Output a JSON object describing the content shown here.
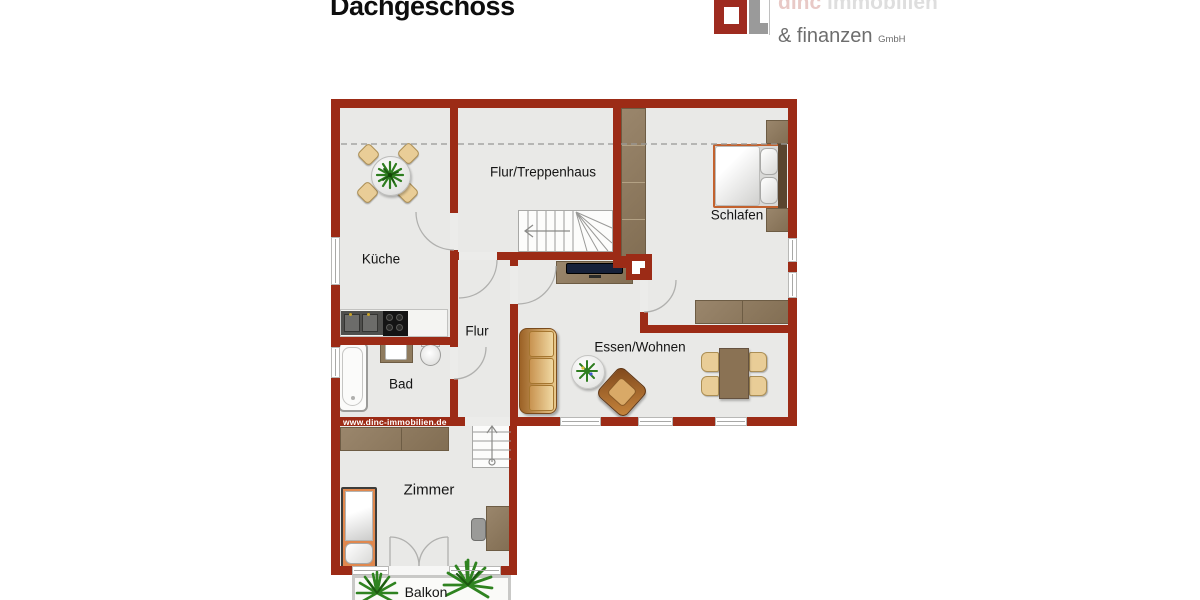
{
  "title": "Dachgeschoss",
  "watermark": "www.dinc-immobilien.de",
  "logo": {
    "brand": "dinc",
    "brand_rest": " immobilien",
    "line2": "& finanzen",
    "suffix": "GmbH"
  },
  "rooms": {
    "kueche": "Küche",
    "flur_treppenhaus": "Flur/Treppenhaus",
    "schlafen": "Schlafen",
    "flur": "Flur",
    "bad": "Bad",
    "essen_wohnen": "Essen/Wohnen",
    "zimmer": "Zimmer",
    "balkon": "Balkon"
  },
  "colors": {
    "wall": "#9c2b16",
    "floor": "#e9e9e7",
    "wood": "#8f7b5e",
    "accent_red": "#a82c20",
    "plant_green": "#2e7d1f"
  }
}
